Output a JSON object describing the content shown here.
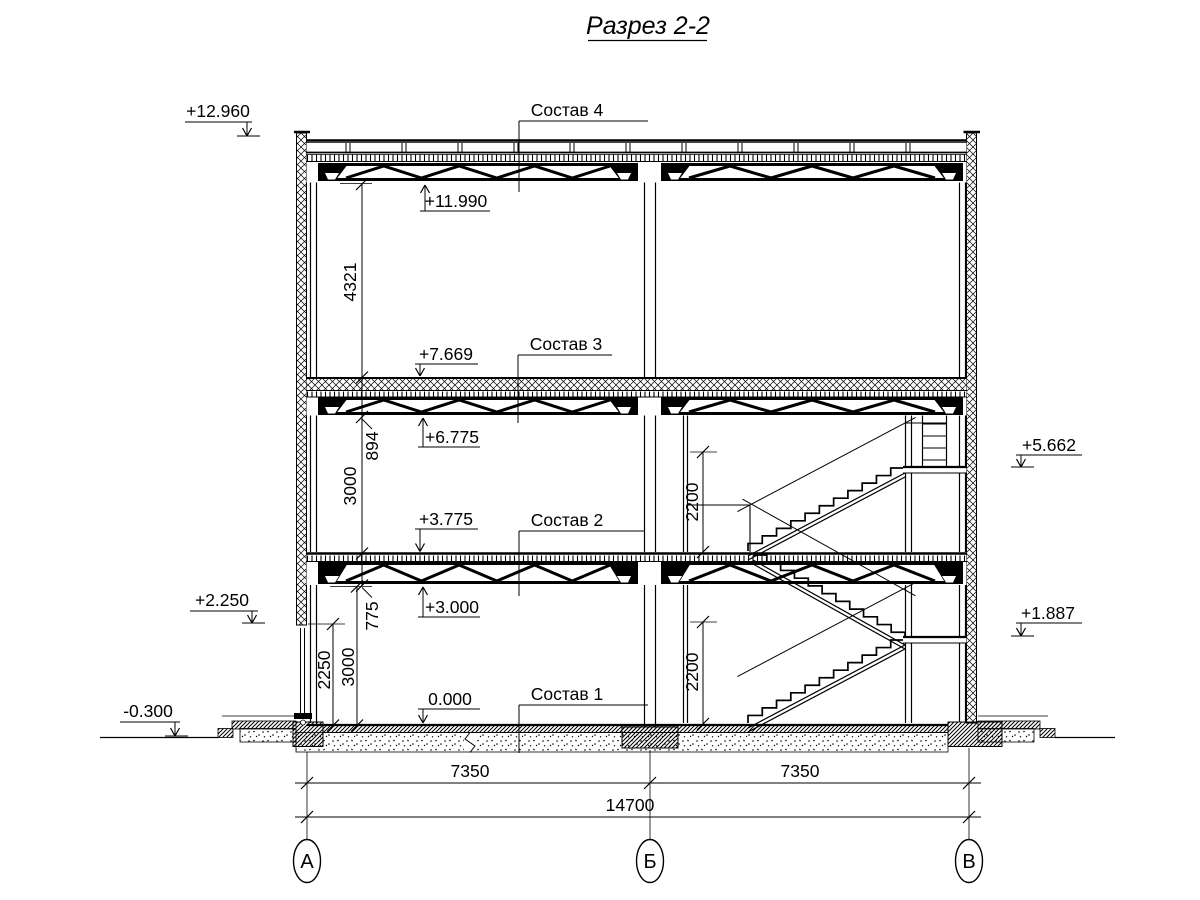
{
  "title": "Разрез 2-2",
  "elevations": {
    "e12960": "+12.960",
    "e11990": "+11.990",
    "e7669": "+7.669",
    "e6775": "+6.775",
    "e3775": "+3.775",
    "e3000": "+3.000",
    "e0": "0.000",
    "e2250": "+2.250",
    "em0300": "-0.300",
    "e5662": "+5.662",
    "e1887": "+1.887"
  },
  "compositions": {
    "c4": "Состав 4",
    "c3": "Состав 3",
    "c2": "Состав 2",
    "c1": "Состав 1"
  },
  "dimensions": {
    "d4321": "4321",
    "d894": "894",
    "d3000u": "3000",
    "d775": "775",
    "d3000l": "3000",
    "d2250": "2250",
    "d2200u": "2200",
    "d2200l": "2200",
    "span_left": "7350",
    "span_right": "7350",
    "span_total": "14700"
  },
  "axes": {
    "left": "А",
    "middle": "Б",
    "right": "В"
  },
  "colors": {
    "ink": "#000000",
    "background": "#ffffff"
  }
}
